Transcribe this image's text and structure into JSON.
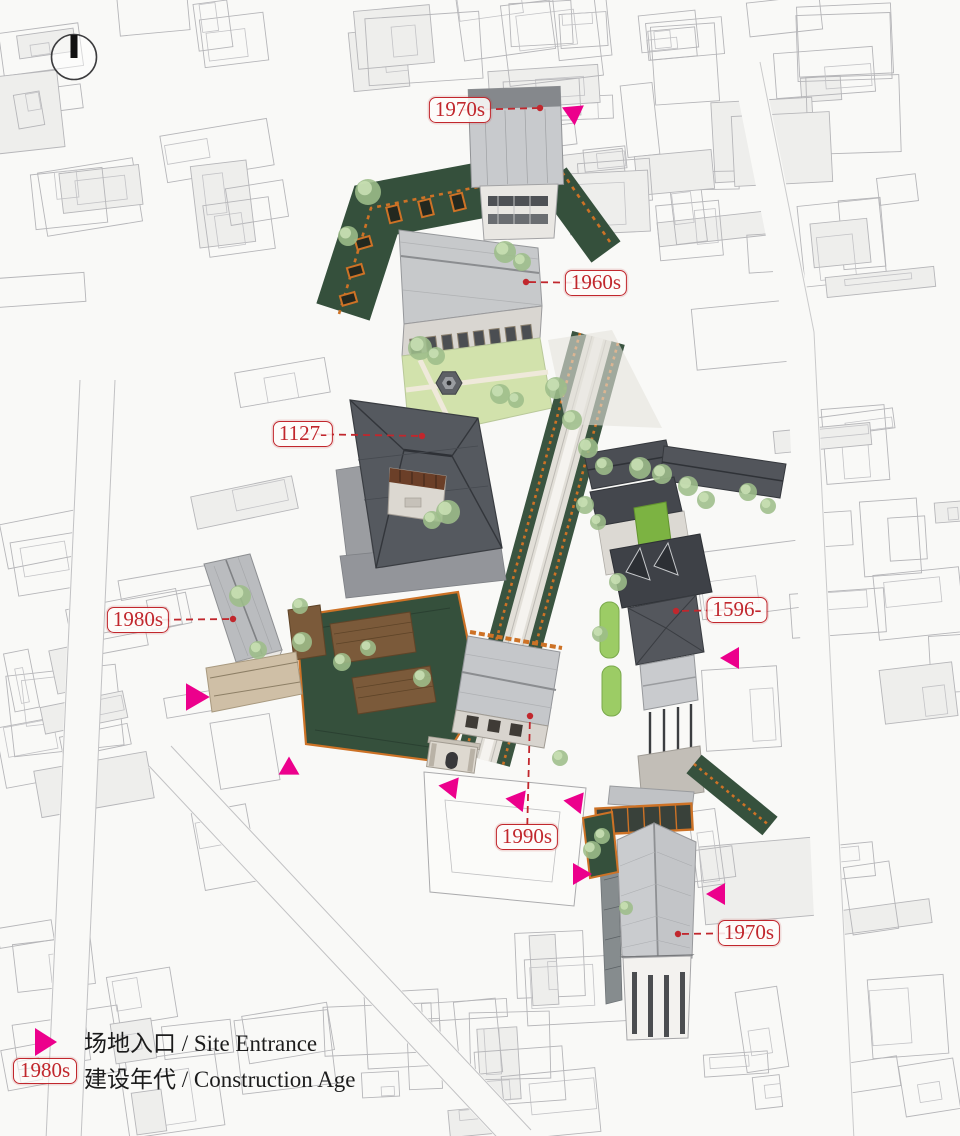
{
  "page": {
    "width": 960,
    "height": 1136,
    "background": "#f9f9f7"
  },
  "colors": {
    "label_red": "#c1272d",
    "entrance_magenta": "#ec008c",
    "green_roof": "#35503c",
    "orange_trim": "#cd7226",
    "lawn_green": "#cfe0ab",
    "bright_lawn": "#7cb342",
    "ink": "#1c1c1c"
  },
  "age_labels": [
    {
      "text": "1970s",
      "box_x": 460,
      "box_y": 110,
      "dot_x": 540,
      "dot_y": 108
    },
    {
      "text": "1960s",
      "box_x": 596,
      "box_y": 283,
      "dot_x": 526,
      "dot_y": 282
    },
    {
      "text": "1127-",
      "box_x": 303,
      "box_y": 434,
      "dot_x": 422,
      "dot_y": 436
    },
    {
      "text": "1596-",
      "box_x": 737,
      "box_y": 610,
      "dot_x": 676,
      "dot_y": 611
    },
    {
      "text": "1980s",
      "box_x": 138,
      "box_y": 620,
      "dot_x": 233,
      "dot_y": 619
    },
    {
      "text": "1990s",
      "box_x": 527,
      "box_y": 837,
      "dot_x": 530,
      "dot_y": 716
    },
    {
      "text": "1970s",
      "box_x": 749,
      "box_y": 933,
      "dot_x": 678,
      "dot_y": 934
    }
  ],
  "site_entrances": [
    {
      "x": 572,
      "y": 112,
      "angle": 205,
      "size": 1.0
    },
    {
      "x": 196,
      "y": 697,
      "angle": 0,
      "size": 1.25
    },
    {
      "x": 289,
      "y": 767,
      "angle": -90,
      "size": 0.95
    },
    {
      "x": 452,
      "y": 786,
      "angle": -52,
      "size": 1.0
    },
    {
      "x": 519,
      "y": 799,
      "angle": -52,
      "size": 1.0
    },
    {
      "x": 577,
      "y": 801,
      "angle": -52,
      "size": 1.0
    },
    {
      "x": 581,
      "y": 874,
      "angle": 0,
      "size": 1.0
    },
    {
      "x": 717,
      "y": 894,
      "angle": 180,
      "size": 1.0
    },
    {
      "x": 731,
      "y": 658,
      "angle": 180,
      "size": 1.0
    }
  ],
  "legend": {
    "entrance_label": "场地入口 / Site Entrance",
    "age_sample": "1980s",
    "age_label": "建设年代 / Construction Age"
  }
}
